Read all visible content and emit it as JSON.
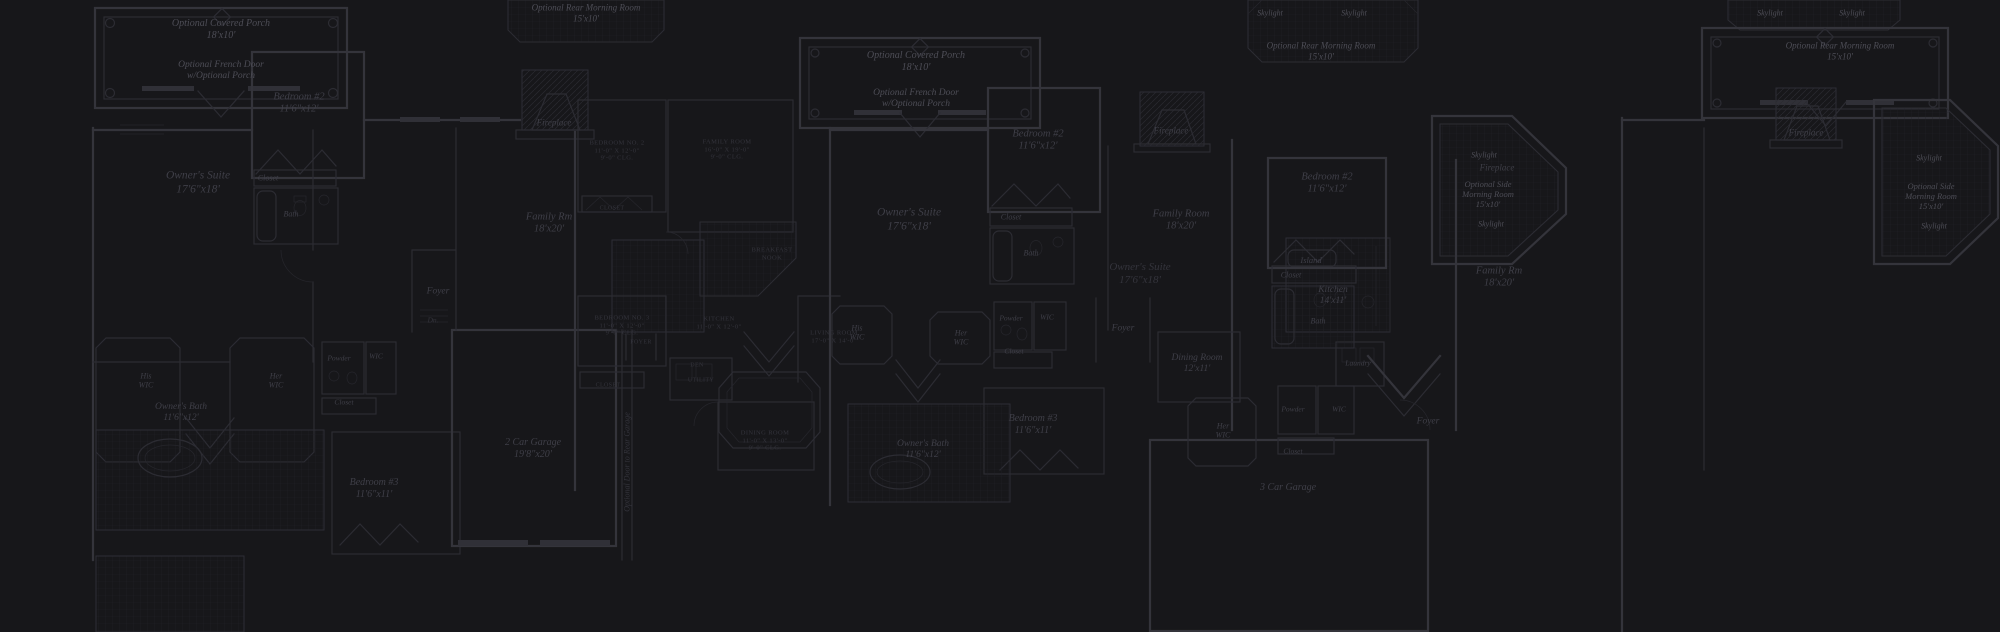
{
  "canvas": {
    "width": 2000,
    "height": 632,
    "background": "#17171a",
    "wall_color": "#34343b",
    "wall_interior_color": "#2c2c33",
    "tile_line_color": "#202025",
    "label_bright": "#4d4d56",
    "label_normal": "#3f3f48",
    "label_dim": "#34343c"
  },
  "plans": [
    {
      "name": "left-floorplan",
      "labels": [
        {
          "name": "optional-covered-porch-label",
          "text": [
            "Optional Covered Porch",
            "18'x10'"
          ],
          "x": 221,
          "y": 30,
          "size": 10,
          "style": "italic",
          "tone": "bright"
        },
        {
          "name": "optional-french-door-label",
          "text": [
            "Optional French Door",
            "w/Optional Porch"
          ],
          "x": 221,
          "y": 71,
          "size": 9.5,
          "style": "italic",
          "tone": "bright"
        },
        {
          "name": "bedroom-2-label",
          "text": [
            "Bedroom #2",
            "11'6\"x12'"
          ],
          "x": 299,
          "y": 104,
          "size": 10.5,
          "style": "italic",
          "tone": "normal"
        },
        {
          "name": "owners-suite-label",
          "text": [
            "Owner's Suite",
            "17'6\"x18'"
          ],
          "x": 198,
          "y": 183,
          "size": 11.5,
          "style": "italic",
          "tone": "normal"
        },
        {
          "name": "closet-label",
          "text": [
            "Closet"
          ],
          "x": 268,
          "y": 178,
          "size": 8,
          "style": "italic",
          "tone": "normal"
        },
        {
          "name": "bath-label",
          "text": [
            "Bath"
          ],
          "x": 291,
          "y": 214,
          "size": 8,
          "style": "italic",
          "tone": "normal"
        },
        {
          "name": "fireplace-label",
          "text": [
            "Fireplace"
          ],
          "x": 554,
          "y": 123,
          "size": 9,
          "style": "italic",
          "tone": "normal"
        },
        {
          "name": "family-rm-label",
          "text": [
            "Family Rm",
            "18'x20'"
          ],
          "x": 549,
          "y": 224,
          "size": 10.5,
          "style": "italic",
          "tone": "normal"
        },
        {
          "name": "his-wic-label",
          "text": [
            "His",
            "WIC"
          ],
          "x": 146,
          "y": 381,
          "size": 8,
          "style": "italic",
          "tone": "normal"
        },
        {
          "name": "her-wic-label",
          "text": [
            "Her",
            "WIC"
          ],
          "x": 276,
          "y": 381,
          "size": 8,
          "style": "italic",
          "tone": "normal"
        },
        {
          "name": "powder-label",
          "text": [
            "Powder"
          ],
          "x": 339,
          "y": 359,
          "size": 7.5,
          "style": "italic",
          "tone": "normal"
        },
        {
          "name": "wic-label",
          "text": [
            "WIC"
          ],
          "x": 376,
          "y": 357,
          "size": 7.5,
          "style": "italic",
          "tone": "normal"
        },
        {
          "name": "closet-2-label",
          "text": [
            "Closet"
          ],
          "x": 344,
          "y": 403,
          "size": 7.5,
          "style": "italic",
          "tone": "normal"
        },
        {
          "name": "owners-bath-label",
          "text": [
            "Owner's Bath",
            "11'6\"x12'"
          ],
          "x": 181,
          "y": 413,
          "size": 9.5,
          "style": "italic",
          "tone": "normal"
        },
        {
          "name": "foyer-label",
          "text": [
            "Foyer"
          ],
          "x": 438,
          "y": 292,
          "size": 9.5,
          "style": "italic",
          "tone": "normal"
        },
        {
          "name": "dn-label",
          "text": [
            "Dn."
          ],
          "x": 433,
          "y": 321,
          "size": 7.5,
          "style": "italic",
          "tone": "dim"
        },
        {
          "name": "bedroom-3-label",
          "text": [
            "Bedroom #3",
            "11'6\"x11'"
          ],
          "x": 374,
          "y": 489,
          "size": 10,
          "style": "italic",
          "tone": "normal"
        },
        {
          "name": "two-car-garage-label",
          "text": [
            "2 Car Garage",
            "19'8\"x20'"
          ],
          "x": 533,
          "y": 449,
          "size": 10,
          "style": "italic",
          "tone": "normal"
        },
        {
          "name": "optional-door-rear-garage-label",
          "text": [
            "Optional Door to Rear Garage"
          ],
          "x": 627,
          "y": 462,
          "size": 8,
          "style": "italic",
          "tone": "dim",
          "rotate": -90
        },
        {
          "name": "optional-rear-morning-room-label",
          "text": [
            "Optional Rear Morning Room",
            "15'x10'"
          ],
          "x": 586,
          "y": 13,
          "size": 9,
          "style": "italic",
          "tone": "bright"
        }
      ]
    },
    {
      "name": "center-floorplan-blueprint",
      "labels": [
        {
          "name": "bp-bedroom-2-label",
          "text": [
            "BEDROOM NO. 2",
            "11'-0\" X 12'-0\"",
            "9'-0\" CLG."
          ],
          "x": 617,
          "y": 151,
          "size": 6.5,
          "style": "caps",
          "tone": "dim"
        },
        {
          "name": "bp-family-room-label",
          "text": [
            "FAMILY ROOM",
            "16'-0\" X 19'-0\"",
            "9'-0\" CLG."
          ],
          "x": 727,
          "y": 150,
          "size": 6.5,
          "style": "caps",
          "tone": "dim"
        },
        {
          "name": "bp-closet-top-label",
          "text": [
            "CLOSET"
          ],
          "x": 612,
          "y": 209,
          "size": 6,
          "style": "caps",
          "tone": "dim"
        },
        {
          "name": "bp-breakfast-nook-label",
          "text": [
            "BREAKFAST",
            "NOOK"
          ],
          "x": 772,
          "y": 254,
          "size": 6.5,
          "style": "caps",
          "tone": "dim"
        },
        {
          "name": "bp-kitchen-label",
          "text": [
            "KITCHEN",
            "11'-0\" X 12'-0\""
          ],
          "x": 719,
          "y": 323,
          "size": 6.5,
          "style": "caps",
          "tone": "dim"
        },
        {
          "name": "bp-bedroom-3-label",
          "text": [
            "BEDROOM NO. 3",
            "11'-0\" X 12'-0\"",
            "9'-0\" CLG."
          ],
          "x": 622,
          "y": 326,
          "size": 6.5,
          "style": "caps",
          "tone": "dim"
        },
        {
          "name": "bp-living-room-label",
          "text": [
            "LIVING ROOM",
            "17'-0\" X 14'-0\""
          ],
          "x": 834,
          "y": 337,
          "size": 6.5,
          "style": "caps",
          "tone": "dim"
        },
        {
          "name": "bp-foyer-label",
          "text": [
            "FOYER"
          ],
          "x": 641,
          "y": 343,
          "size": 6,
          "style": "caps",
          "tone": "dim"
        },
        {
          "name": "bp-den-label",
          "text": [
            "DEN"
          ],
          "x": 697,
          "y": 366,
          "size": 6,
          "style": "caps",
          "tone": "dim"
        },
        {
          "name": "bp-closet-label",
          "text": [
            "CLOSET"
          ],
          "x": 608,
          "y": 386,
          "size": 6,
          "style": "caps",
          "tone": "dim"
        },
        {
          "name": "bp-utility-label",
          "text": [
            "UTILITY"
          ],
          "x": 701,
          "y": 381,
          "size": 6,
          "style": "caps",
          "tone": "dim"
        },
        {
          "name": "bp-dining-room-label",
          "text": [
            "DINING ROOM",
            "11'-0\" X 13'-0\"",
            "9'-0\" CLG."
          ],
          "x": 765,
          "y": 441,
          "size": 6.5,
          "style": "caps",
          "tone": "dim"
        }
      ]
    },
    {
      "name": "right-floorplan",
      "labels": [
        {
          "name": "r-optional-covered-porch-label",
          "text": [
            "Optional Covered Porch",
            "18'x10'"
          ],
          "x": 916,
          "y": 62,
          "size": 10,
          "style": "italic",
          "tone": "bright"
        },
        {
          "name": "r-optional-french-door-label",
          "text": [
            "Optional French Door",
            "w/Optional Porch"
          ],
          "x": 916,
          "y": 99,
          "size": 9.5,
          "style": "italic",
          "tone": "bright"
        },
        {
          "name": "r-bedroom-2-label",
          "text": [
            "Bedroom #2",
            "11'6\"x12'"
          ],
          "x": 1038,
          "y": 141,
          "size": 10.5,
          "style": "italic",
          "tone": "normal"
        },
        {
          "name": "r-owners-suite-label",
          "text": [
            "Owner's Suite",
            "17'6\"x18'"
          ],
          "x": 909,
          "y": 220,
          "size": 11.5,
          "style": "italic",
          "tone": "normal"
        },
        {
          "name": "r-closet-label",
          "text": [
            "Closet"
          ],
          "x": 1011,
          "y": 217,
          "size": 8,
          "style": "italic",
          "tone": "normal"
        },
        {
          "name": "r-bath-label",
          "text": [
            "Bath"
          ],
          "x": 1031,
          "y": 253,
          "size": 8,
          "style": "italic",
          "tone": "normal"
        },
        {
          "name": "r-fireplace-label",
          "text": [
            "Fireplace"
          ],
          "x": 1171,
          "y": 131,
          "size": 9,
          "style": "italic",
          "tone": "normal"
        },
        {
          "name": "r-family-room-label",
          "text": [
            "Family Room",
            "18'x20'"
          ],
          "x": 1181,
          "y": 221,
          "size": 10.5,
          "style": "italic",
          "tone": "normal"
        },
        {
          "name": "r-skylight-1-label",
          "text": [
            "Skylight"
          ],
          "x": 1270,
          "y": 13,
          "size": 8,
          "style": "italic",
          "tone": "bright"
        },
        {
          "name": "r-skylight-2-label",
          "text": [
            "Skylight"
          ],
          "x": 1354,
          "y": 13,
          "size": 8,
          "style": "italic",
          "tone": "bright"
        },
        {
          "name": "r-rear-morning-room-label",
          "text": [
            "Optional Rear Morning Room",
            "15'x10'"
          ],
          "x": 1321,
          "y": 51,
          "size": 9,
          "style": "italic",
          "tone": "bright"
        },
        {
          "name": "r-island-label",
          "text": [
            "Island"
          ],
          "x": 1311,
          "y": 260,
          "size": 8.5,
          "style": "italic",
          "tone": "normal"
        },
        {
          "name": "r-kitchen-label",
          "text": [
            "Kitchen",
            "14'x11'"
          ],
          "x": 1333,
          "y": 296,
          "size": 9.5,
          "style": "italic",
          "tone": "normal"
        },
        {
          "name": "r-his-wic-label",
          "text": [
            "His",
            "WIC"
          ],
          "x": 857,
          "y": 333,
          "size": 8,
          "style": "italic",
          "tone": "normal"
        },
        {
          "name": "r-her-wic-label",
          "text": [
            "Her",
            "WIC"
          ],
          "x": 961,
          "y": 338,
          "size": 8,
          "style": "italic",
          "tone": "normal"
        },
        {
          "name": "r-powder-label",
          "text": [
            "Powder"
          ],
          "x": 1011,
          "y": 319,
          "size": 7.5,
          "style": "italic",
          "tone": "normal"
        },
        {
          "name": "r-wic-label",
          "text": [
            "WIC"
          ],
          "x": 1047,
          "y": 318,
          "size": 7.5,
          "style": "italic",
          "tone": "normal"
        },
        {
          "name": "r-closet-2-label",
          "text": [
            "Closet"
          ],
          "x": 1014,
          "y": 352,
          "size": 7.5,
          "style": "italic",
          "tone": "normal"
        },
        {
          "name": "r-foyer-label",
          "text": [
            "Foyer"
          ],
          "x": 1123,
          "y": 329,
          "size": 9.5,
          "style": "italic",
          "tone": "normal"
        },
        {
          "name": "r-dining-room-label",
          "text": [
            "Dining Room",
            "12'x11'"
          ],
          "x": 1197,
          "y": 364,
          "size": 9.5,
          "style": "italic",
          "tone": "normal"
        },
        {
          "name": "r-laundry-label",
          "text": [
            "Laundry"
          ],
          "x": 1358,
          "y": 364,
          "size": 7.5,
          "style": "italic",
          "tone": "normal"
        },
        {
          "name": "r-bedroom-3-label",
          "text": [
            "Bedroom #3",
            "11'6\"x11'"
          ],
          "x": 1033,
          "y": 425,
          "size": 10,
          "style": "italic",
          "tone": "normal"
        },
        {
          "name": "r-owners-bath-label",
          "text": [
            "Owner's Bath",
            "11'6\"x12'"
          ],
          "x": 923,
          "y": 450,
          "size": 9.5,
          "style": "italic",
          "tone": "normal"
        },
        {
          "name": "r-three-car-garage-label",
          "text": [
            "3 Car Garage"
          ],
          "x": 1288,
          "y": 488,
          "size": 10,
          "style": "italic",
          "tone": "normal"
        },
        {
          "name": "r-skylight-3-label",
          "text": [
            "Skylight"
          ],
          "x": 1484,
          "y": 155,
          "size": 8,
          "style": "italic",
          "tone": "bright"
        },
        {
          "name": "r-side-morning-room-label",
          "text": [
            "Optional Side",
            "Morning Room",
            "15'x10'"
          ],
          "x": 1488,
          "y": 194,
          "size": 8.5,
          "style": "italic",
          "tone": "bright"
        },
        {
          "name": "r-skylight-4-label",
          "text": [
            "Skylight"
          ],
          "x": 1491,
          "y": 224,
          "size": 8,
          "style": "italic",
          "tone": "bright"
        }
      ]
    },
    {
      "name": "overlay-floorplan",
      "labels": [
        {
          "name": "o-bedroom-2-label",
          "text": [
            "Bedroom #2",
            "11'6\"x12'"
          ],
          "x": 1327,
          "y": 184,
          "size": 10.5,
          "style": "italic",
          "tone": "normal"
        },
        {
          "name": "o-closet-label",
          "text": [
            "Closet"
          ],
          "x": 1291,
          "y": 275,
          "size": 8,
          "style": "italic",
          "tone": "normal"
        },
        {
          "name": "o-bath-label",
          "text": [
            "Bath"
          ],
          "x": 1318,
          "y": 321,
          "size": 8,
          "style": "italic",
          "tone": "normal"
        },
        {
          "name": "o-owners-suite-label",
          "text": [
            "Owner's Suite",
            "17'6\"x18'"
          ],
          "x": 1140,
          "y": 274,
          "size": 11,
          "style": "italic",
          "tone": "dim"
        },
        {
          "name": "o-family-rm-label",
          "text": [
            "Family Rm",
            "18'x20'"
          ],
          "x": 1499,
          "y": 278,
          "size": 10.5,
          "style": "italic",
          "tone": "normal"
        },
        {
          "name": "o-fireplace-label",
          "text": [
            "Fireplace"
          ],
          "x": 1497,
          "y": 168,
          "size": 9,
          "style": "italic",
          "tone": "normal"
        },
        {
          "name": "o-powder-label",
          "text": [
            "Powder"
          ],
          "x": 1293,
          "y": 410,
          "size": 7.5,
          "style": "italic",
          "tone": "normal"
        },
        {
          "name": "o-wic-label",
          "text": [
            "WIC"
          ],
          "x": 1339,
          "y": 410,
          "size": 7.5,
          "style": "italic",
          "tone": "normal"
        },
        {
          "name": "o-closet-2-label",
          "text": [
            "Closet"
          ],
          "x": 1293,
          "y": 452,
          "size": 7.5,
          "style": "italic",
          "tone": "normal"
        },
        {
          "name": "o-her-wic-label",
          "text": [
            "Her",
            "WIC"
          ],
          "x": 1223,
          "y": 431,
          "size": 8,
          "style": "italic",
          "tone": "normal"
        },
        {
          "name": "o-foyer-label",
          "text": [
            "Foyer"
          ],
          "x": 1428,
          "y": 422,
          "size": 9.5,
          "style": "italic",
          "tone": "normal"
        }
      ]
    },
    {
      "name": "far-right-floorplan",
      "labels": [
        {
          "name": "f-skylight-1-label",
          "text": [
            "Skylight"
          ],
          "x": 1770,
          "y": 13,
          "size": 8,
          "style": "italic",
          "tone": "bright"
        },
        {
          "name": "f-skylight-2-label",
          "text": [
            "Skylight"
          ],
          "x": 1852,
          "y": 13,
          "size": 8,
          "style": "italic",
          "tone": "bright"
        },
        {
          "name": "f-rear-morning-room-label",
          "text": [
            "Optional Rear Morning Room",
            "15'x10'"
          ],
          "x": 1840,
          "y": 51,
          "size": 9,
          "style": "italic",
          "tone": "bright"
        },
        {
          "name": "f-fireplace-label",
          "text": [
            "Fireplace"
          ],
          "x": 1806,
          "y": 133,
          "size": 9,
          "style": "italic",
          "tone": "normal"
        },
        {
          "name": "f-skylight-3-label",
          "text": [
            "Skylight"
          ],
          "x": 1929,
          "y": 158,
          "size": 8,
          "style": "italic",
          "tone": "bright"
        },
        {
          "name": "f-side-morning-room-label",
          "text": [
            "Optional Side",
            "Morning Room",
            "15'x10'"
          ],
          "x": 1931,
          "y": 196,
          "size": 8.5,
          "style": "italic",
          "tone": "bright"
        },
        {
          "name": "f-skylight-4-label",
          "text": [
            "Skylight"
          ],
          "x": 1934,
          "y": 226,
          "size": 8,
          "style": "italic",
          "tone": "bright"
        }
      ]
    }
  ]
}
